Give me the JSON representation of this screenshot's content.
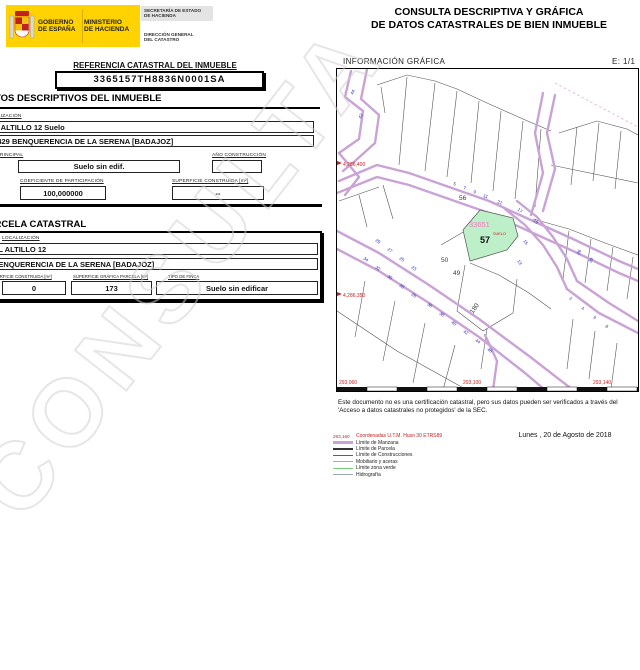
{
  "header": {
    "logo": {
      "gobierno1": "GOBIERNO",
      "gobierno2": "DE ESPAÑA",
      "ministerio1": "MINISTERIO",
      "ministerio2": "DE HACIENDA",
      "secretaria1": "SECRETARÍA DE ESTADO",
      "secretaria2": "DE HACIENDA",
      "direccion1": "DIRECCIÓN GENERAL",
      "direccion2": "DEL CATASTRO"
    },
    "title1": "CONSULTA DESCRIPTIVA Y GRÁFICA",
    "title2": "DE DATOS CATASTRALES DE BIEN INMUEBLE"
  },
  "doc": {
    "ref_label": "REFERENCIA CATASTRAL DEL INMUEBLE",
    "ref_value": "3365157TH8836N0001SA",
    "datos_header": "DATOS DESCRIPTIVOS DEL INMUEBLE",
    "localizacion_label": "LOCALIZACIÓN",
    "address_line1": "CL ALTILLO 12 Suelo",
    "address_line2": "06429 BENQUERENCIA DE LA SERENA [BADAJOZ]",
    "uso_label": "USO PRINCIPAL",
    "uso_value": "Suelo sin edif.",
    "anio_label": "AÑO CONSTRUCCIÓN",
    "anio_value": "",
    "coef_label": "COEFICIENTE DE PARTICIPACIÓN",
    "coef_value": "100,000000",
    "sup_label": "SUPERFICIE CONSTRUIDA [m²]",
    "sup_value": "--",
    "parcela_header": "PARCELA CATASTRAL",
    "parcela": {
      "localizacion_label": "LOCALIZACIÓN",
      "address_line1": "CL ALTILLO 12",
      "address_line2": "BENQUERENCIA DE LA SERENA [BADAJOZ]",
      "sup_construida_label": "SUPERFICIE CONSTRUIDA [m²]",
      "sup_construida_value": "0",
      "sup_grafica_label": "SUPERFICIE GRÁFICA PARCELA [m²]",
      "sup_grafica_value": "173",
      "tipo_label": "TIPO DE FINCA",
      "tipo_value": "Suelo sin edificar"
    },
    "watermark": "CONSULTA"
  },
  "map": {
    "header": "INFORMACIÓN GRÁFICA",
    "scale": "E: 1/1",
    "parcel": {
      "id": "33651",
      "number": "57",
      "tag": "SUELO"
    },
    "coord_labels": {
      "left_top": "4,286,400",
      "left_bottom": "4,286,350",
      "bottom_left": "293,060",
      "bottom_mid": "293,100",
      "bottom_right": "293,140"
    },
    "plot_numbers": [
      {
        "t": "56",
        "x": 122,
        "y": 131
      },
      {
        "t": "50",
        "x": 104,
        "y": 193
      },
      {
        "t": "49",
        "x": 116,
        "y": 206
      },
      {
        "t": "180",
        "x": 136,
        "y": 245,
        "r": -55
      }
    ],
    "street_numbers": [
      {
        "t": "44",
        "x": 16,
        "y": 26,
        "r": -65
      },
      {
        "t": "42",
        "x": 24,
        "y": 50,
        "r": -65
      },
      {
        "t": "29",
        "x": 38,
        "y": 172,
        "r": 35
      },
      {
        "t": "27",
        "x": 50,
        "y": 181,
        "r": 35
      },
      {
        "t": "25",
        "x": 62,
        "y": 190,
        "r": 35
      },
      {
        "t": "23",
        "x": 74,
        "y": 199,
        "r": 35
      },
      {
        "t": "34",
        "x": 26,
        "y": 190,
        "r": 35
      },
      {
        "t": "32",
        "x": 38,
        "y": 199,
        "r": 35
      },
      {
        "t": "30",
        "x": 50,
        "y": 208,
        "r": 35
      },
      {
        "t": "28",
        "x": 62,
        "y": 217,
        "r": 35
      },
      {
        "t": "26",
        "x": 74,
        "y": 226,
        "r": 35
      },
      {
        "t": "36",
        "x": 90,
        "y": 236,
        "r": 35
      },
      {
        "t": "38",
        "x": 102,
        "y": 245,
        "r": 35
      },
      {
        "t": "40",
        "x": 114,
        "y": 254,
        "r": 35
      },
      {
        "t": "42",
        "x": 126,
        "y": 263,
        "r": 35
      },
      {
        "t": "44",
        "x": 138,
        "y": 272,
        "r": 35
      },
      {
        "t": "46",
        "x": 150,
        "y": 281,
        "r": 35
      },
      {
        "t": "5",
        "x": 116,
        "y": 116,
        "r": 18
      },
      {
        "t": "7",
        "x": 126,
        "y": 120,
        "r": 18
      },
      {
        "t": "9",
        "x": 136,
        "y": 124,
        "r": 18
      },
      {
        "t": "11",
        "x": 146,
        "y": 128,
        "r": 18
      },
      {
        "t": "21",
        "x": 160,
        "y": 134,
        "r": 18
      },
      {
        "t": "17",
        "x": 180,
        "y": 141,
        "r": 40
      },
      {
        "t": "19",
        "x": 196,
        "y": 152,
        "r": 40
      },
      {
        "t": "15",
        "x": 186,
        "y": 172,
        "r": 55
      },
      {
        "t": "13",
        "x": 180,
        "y": 192,
        "r": 55
      },
      {
        "t": "2",
        "x": 232,
        "y": 230,
        "r": 32
      },
      {
        "t": "4",
        "x": 244,
        "y": 240,
        "r": 32
      },
      {
        "t": "6",
        "x": 256,
        "y": 249,
        "r": 32
      },
      {
        "t": "8",
        "x": 268,
        "y": 258,
        "r": 32
      },
      {
        "t": "26",
        "x": 242,
        "y": 186,
        "r": -60
      },
      {
        "t": "28",
        "x": 254,
        "y": 194,
        "r": -60
      }
    ]
  },
  "legend": {
    "rows": [
      {
        "swatch": "coords",
        "sample": "293,160",
        "label": "Coordenadas U.T.M. Huso 30 ETRS89"
      },
      {
        "swatch": "manzana",
        "label": "Límite de Manzana"
      },
      {
        "swatch": "parcela",
        "label": "Límite de Parcela"
      },
      {
        "swatch": "construcciones",
        "label": "Límite de Construcciones"
      },
      {
        "swatch": "mobiliario",
        "label": "Mobiliario y aceras"
      },
      {
        "swatch": "verde",
        "label": "Límite zona verde"
      },
      {
        "swatch": "hidrografia",
        "label": "Hidrografía"
      }
    ]
  },
  "footer": {
    "disclaimer1": "Este documento no es una certificación catastral, pero sus datos pueden ser verificados a través del",
    "disclaimer2": "'Acceso a datos catastrales no protegidos' de la SEC.",
    "date": "Lunes , 20 de Agosto de 2018"
  },
  "colors": {
    "logo_yellow": "#FFD200",
    "manzana_purple": "#C9A3D6",
    "zone_green": "#BDEFC8",
    "parcel_pink": "#F07CC0",
    "coord_red": "#C42222",
    "street_blue": "#2B2BC0"
  }
}
